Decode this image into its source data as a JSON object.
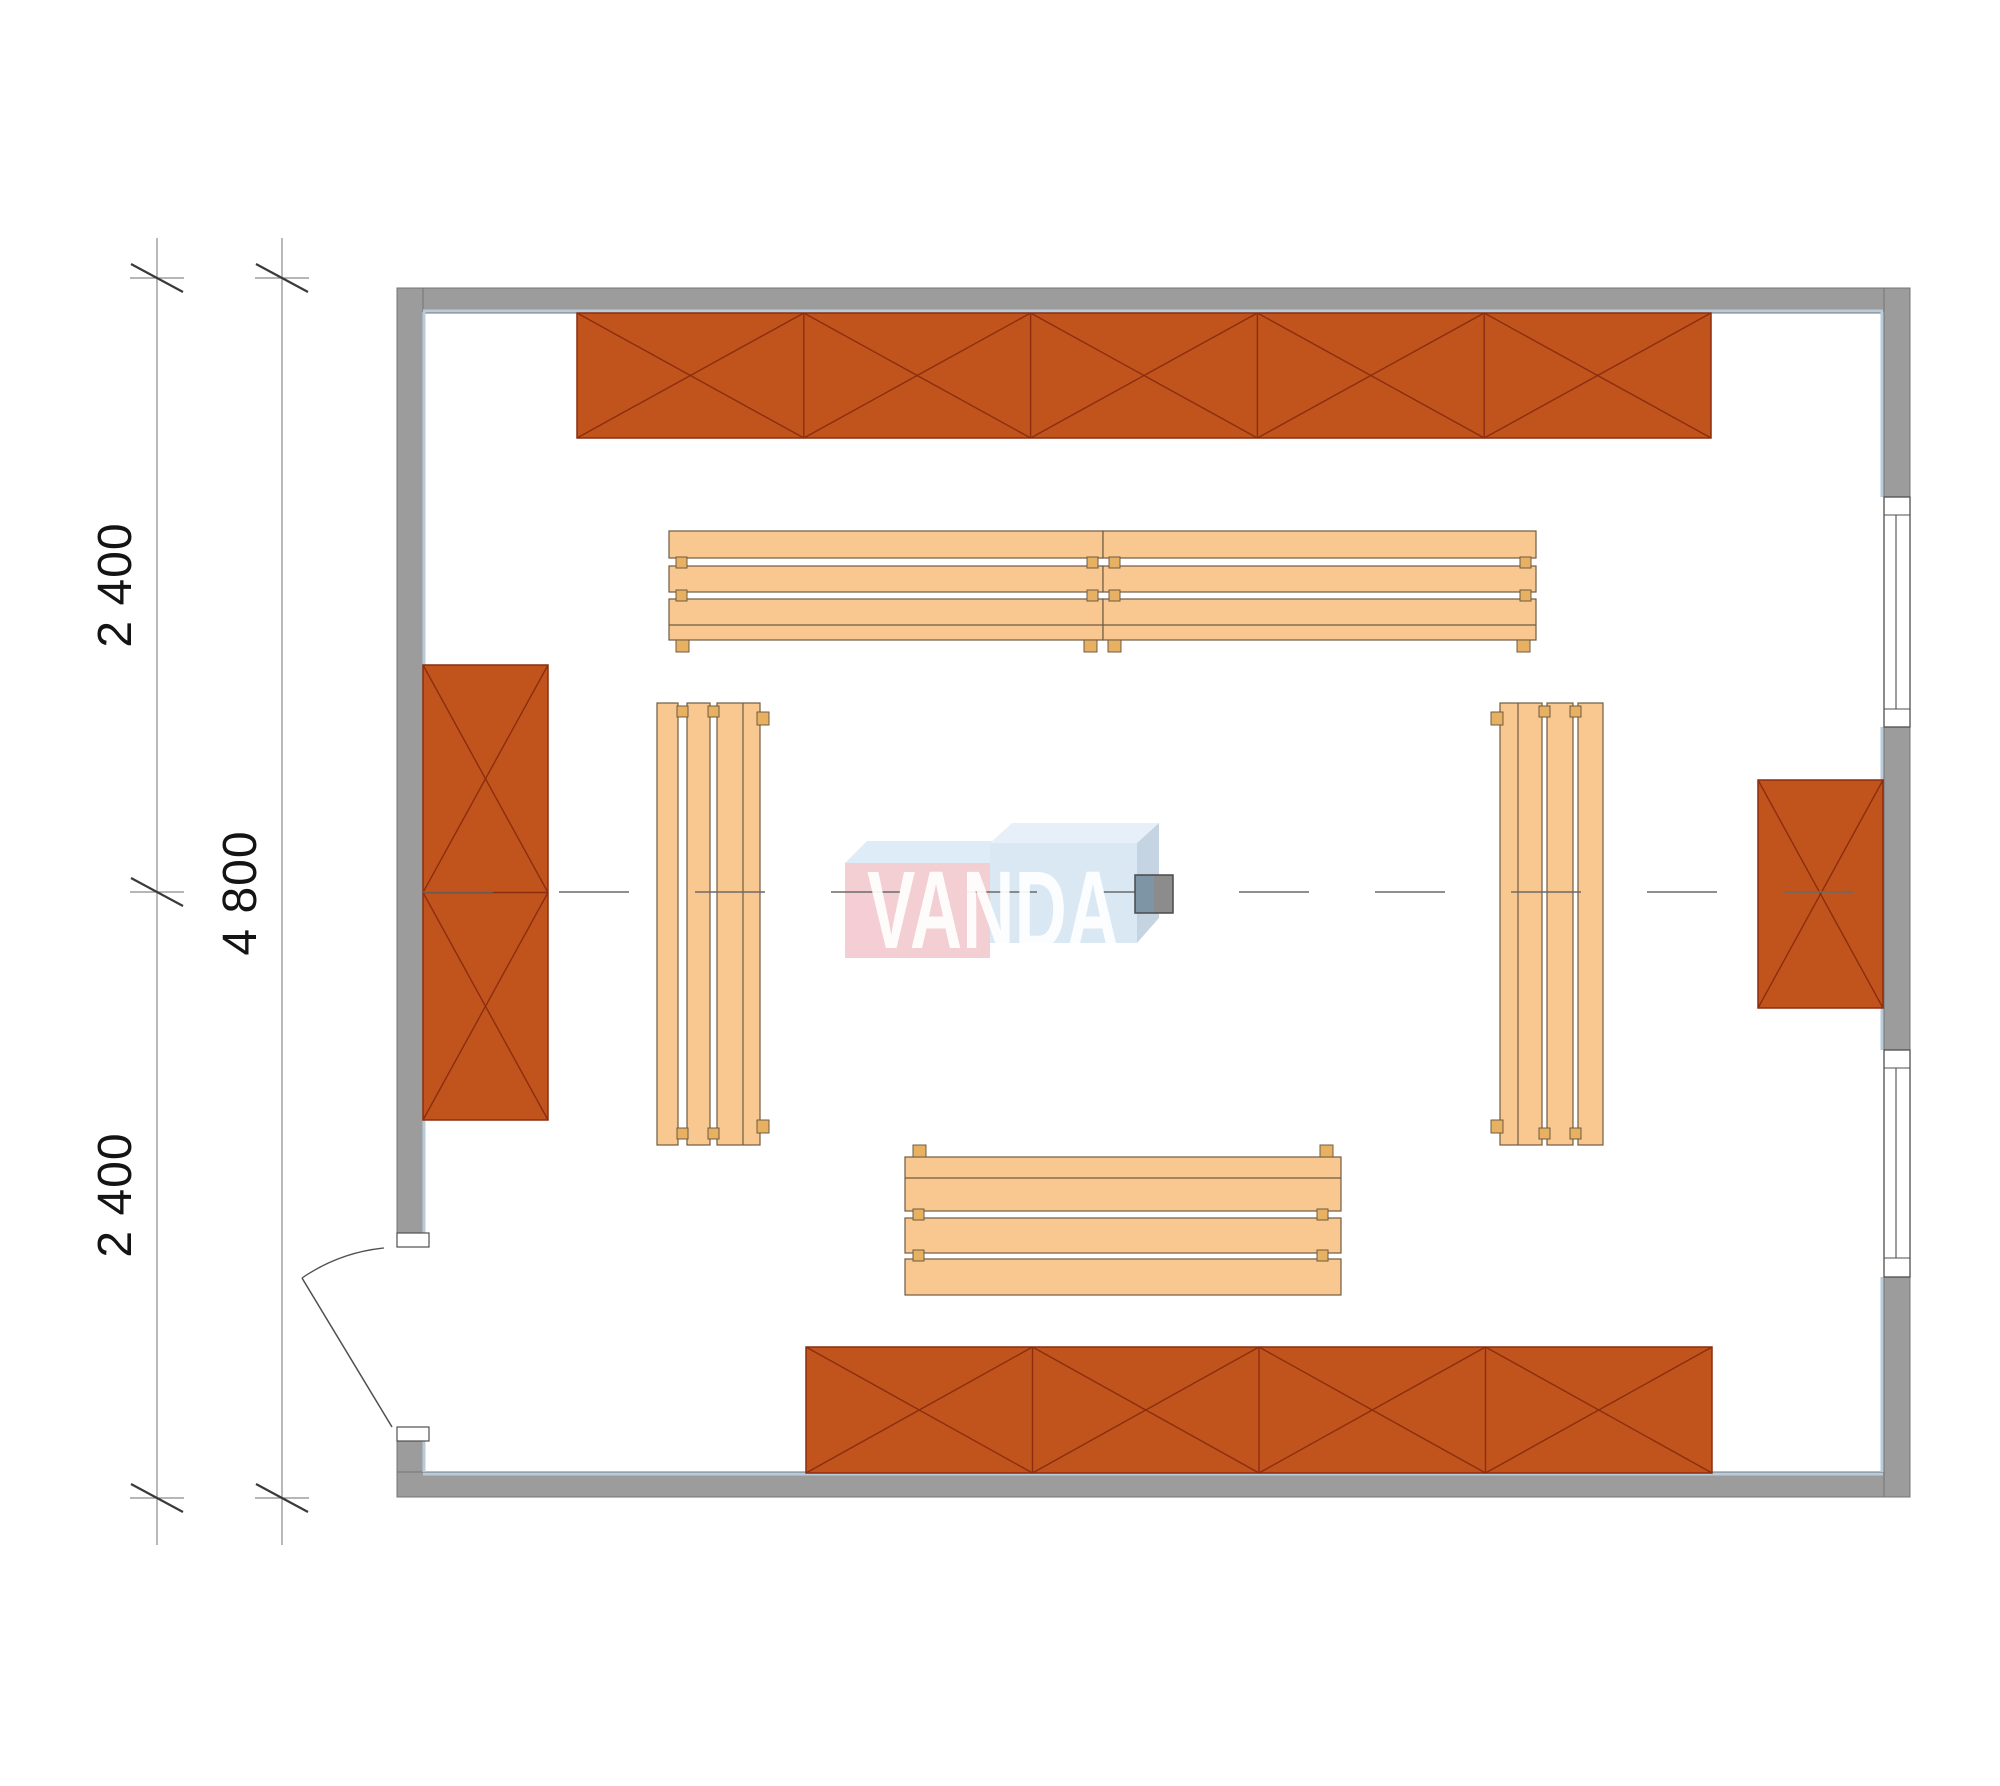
{
  "page": {
    "width": 2000,
    "height": 1786,
    "background": "#ffffff"
  },
  "watermark": {
    "text": "VANDA"
  },
  "dimensions": {
    "labels": [
      {
        "text": "2 400"
      },
      {
        "text": "2 400"
      },
      {
        "text": "4 800"
      }
    ]
  },
  "geometry": {
    "colors": {
      "wall_fill": "#9c9c9c",
      "wall_edge": "#757575",
      "inner_face": "#b7cbdb",
      "shelf_fill": "#c1541d",
      "shelf_line": "#8c2d0e",
      "bench_fill": "#f9c890",
      "bench_line": "#6e5c42",
      "tab_fill": "#e7b161",
      "window_line": "#4f4f4f",
      "door_line": "#4f4f4f",
      "centerline": "#6a6a6a",
      "dim_line": "#8a8a8a",
      "dim_tick": "#3a3a3a",
      "logo_pink": "#f2c6cc",
      "logo_blue_face": "#d4e4f3",
      "logo_blue_top_l": "#d9e9f7",
      "logo_blue_top_r": "#e3eef9",
      "logo_blue_side": "#bccddd",
      "heater_left": "#7e95a6",
      "heater_right": "#8c8c8c",
      "heater_edge": "#4a4a4a"
    },
    "walls": {
      "rects": [
        {
          "name": "wall-top",
          "r": [
            397,
            288,
            1513,
            25
          ]
        },
        {
          "name": "wall-left-upper",
          "r": [
            397,
            288,
            26,
            945
          ]
        },
        {
          "name": "wall-left-lower",
          "r": [
            397,
            1438,
            26,
            59
          ]
        },
        {
          "name": "wall-bottom",
          "r": [
            397,
            1472,
            1513,
            25
          ]
        },
        {
          "name": "wall-right-upper",
          "r": [
            1884,
            288,
            26,
            209
          ]
        },
        {
          "name": "wall-right-middle",
          "r": [
            1884,
            727,
            26,
            323
          ]
        },
        {
          "name": "wall-right-lower",
          "r": [
            1884,
            1277,
            26,
            220
          ]
        }
      ]
    },
    "inner_face_segments": [
      [
        423,
        311,
        1883,
        311
      ],
      [
        423,
        1474,
        1883,
        1474
      ],
      [
        424,
        312,
        424,
        1233
      ],
      [
        424,
        1441,
        424,
        1472
      ],
      [
        1882,
        312,
        1882,
        497
      ],
      [
        1882,
        727,
        1882,
        1050
      ],
      [
        1882,
        1277,
        1882,
        1472
      ]
    ],
    "windows": [
      {
        "name": "window-right-upper",
        "r": [
          1884,
          497,
          26,
          230
        ],
        "lines": [
          [
            1884,
            515,
            1910,
            515
          ],
          [
            1884,
            709,
            1910,
            709
          ],
          [
            1896,
            515,
            1896,
            709
          ]
        ]
      },
      {
        "name": "window-right-lower",
        "r": [
          1884,
          1050,
          26,
          227
        ],
        "lines": [
          [
            1884,
            1068,
            1910,
            1068
          ],
          [
            1884,
            1258,
            1910,
            1258
          ],
          [
            1896,
            1068,
            1896,
            1258
          ]
        ]
      }
    ],
    "door": {
      "jambs": [
        {
          "name": "door-jamb-top",
          "r": [
            397,
            1233,
            32,
            14
          ]
        },
        {
          "name": "door-jamb-bottom",
          "r": [
            397,
            1427,
            32,
            14
          ]
        }
      ],
      "leaf": [
        392,
        1427,
        302,
        1278
      ],
      "arc": "M 384 1248 A 177 177 0 0 0 302 1278"
    },
    "shelves": [
      {
        "name": "shelf-top",
        "x": 577,
        "y": 313,
        "w": 1134,
        "h": 125,
        "cols": 5,
        "rows": 1
      },
      {
        "name": "shelf-left",
        "x": 423,
        "y": 665,
        "w": 125,
        "h": 455,
        "cols": 1,
        "rows": 2
      },
      {
        "name": "shelf-right",
        "x": 1758,
        "y": 780,
        "w": 125,
        "h": 228,
        "cols": 1,
        "rows": 1
      },
      {
        "name": "shelf-bottom",
        "x": 806,
        "y": 1347,
        "w": 906,
        "h": 126,
        "cols": 4,
        "rows": 1
      }
    ],
    "benches": {
      "boards": [
        {
          "name": "bench-top",
          "rects": [
            [
              669,
              531,
              434,
              27
            ],
            [
              669,
              566,
              434,
              26
            ],
            [
              669,
              599,
              434,
              41
            ],
            [
              1103,
              531,
              433,
              27
            ],
            [
              1103,
              566,
              433,
              26
            ],
            [
              1103,
              599,
              433,
              41
            ]
          ],
          "lines": [
            [
              669,
              625,
              1536,
              625
            ]
          ]
        },
        {
          "name": "bench-left",
          "rects": [
            [
              657,
              703,
              21,
              442
            ],
            [
              687,
              703,
              23,
              442
            ],
            [
              717,
              703,
              43,
              442
            ]
          ],
          "lines": [
            [
              743,
              703,
              743,
              1145
            ]
          ]
        },
        {
          "name": "bench-right",
          "rects": [
            [
              1500,
              703,
              42,
              442
            ],
            [
              1547,
              703,
              26,
              442
            ],
            [
              1578,
              703,
              25,
              442
            ]
          ],
          "lines": [
            [
              1518,
              703,
              1518,
              1145
            ]
          ]
        },
        {
          "name": "bench-bottom",
          "rects": [
            [
              905,
              1157,
              436,
              54
            ],
            [
              905,
              1218,
              436,
              35
            ],
            [
              905,
              1259,
              436,
              36
            ]
          ],
          "lines": [
            [
              905,
              1178,
              1341,
              1178
            ]
          ]
        }
      ],
      "tabs": [
        [
          676,
          557,
          11,
          11
        ],
        [
          1087,
          557,
          11,
          11
        ],
        [
          1109,
          557,
          11,
          11
        ],
        [
          1520,
          557,
          11,
          11
        ],
        [
          676,
          590,
          11,
          11
        ],
        [
          1087,
          590,
          11,
          11
        ],
        [
          1109,
          590,
          11,
          11
        ],
        [
          1520,
          590,
          11,
          11
        ],
        [
          677,
          706,
          11,
          11
        ],
        [
          708,
          706,
          11,
          11
        ],
        [
          677,
          1128,
          11,
          11
        ],
        [
          708,
          1128,
          11,
          11
        ],
        [
          1539,
          706,
          11,
          11
        ],
        [
          1570,
          706,
          11,
          11
        ],
        [
          1539,
          1128,
          11,
          11
        ],
        [
          1570,
          1128,
          11,
          11
        ],
        [
          913,
          1209,
          11,
          11
        ],
        [
          1317,
          1209,
          11,
          11
        ],
        [
          913,
          1250,
          11,
          11
        ],
        [
          1317,
          1250,
          11,
          11
        ]
      ],
      "feet": [
        [
          676,
          640,
          13,
          12
        ],
        [
          1084,
          640,
          13,
          12
        ],
        [
          1108,
          640,
          13,
          12
        ],
        [
          1517,
          640,
          13,
          12
        ],
        [
          757,
          712,
          12,
          13
        ],
        [
          757,
          1120,
          12,
          13
        ],
        [
          1491,
          712,
          12,
          13
        ],
        [
          1491,
          1120,
          12,
          13
        ],
        [
          913,
          1145,
          13,
          12
        ],
        [
          1320,
          1145,
          13,
          12
        ]
      ]
    },
    "centerline": {
      "seg": [
        423,
        892,
        1883,
        892
      ],
      "dash": "70 66"
    },
    "heater": {
      "left": [
        1135,
        875,
        19,
        38
      ],
      "right": [
        1154,
        875,
        19,
        38
      ],
      "frame": [
        1135,
        875,
        38,
        38
      ]
    },
    "dimension": {
      "lines": [
        [
          157,
          238,
          157,
          1545
        ],
        [
          282,
          238,
          282,
          1545
        ]
      ],
      "ticks": [
        [
          157,
          278
        ],
        [
          157,
          892
        ],
        [
          157,
          1498
        ],
        [
          282,
          278
        ],
        [
          282,
          1498
        ]
      ],
      "label_pos": [
        {
          "x": 131,
          "y": 585,
          "rot": -90
        },
        {
          "x": 131,
          "y": 1195,
          "rot": -90
        },
        {
          "x": 256,
          "y": 893,
          "rot": -90
        }
      ]
    },
    "logo": {
      "opacity": 0.85,
      "polys": [
        {
          "name": "logo-box-left-top",
          "pts": "867,841 1012,841 990,863 845,863",
          "fill": "logo_blue_top_l"
        },
        {
          "name": "logo-box-left-face",
          "rect": [
            845,
            863,
            145,
            95
          ],
          "fill": "logo_pink"
        },
        {
          "name": "logo-box-right-top",
          "pts": "1012,823 1159,823 1137,843 990,843",
          "fill": "logo_blue_top_r"
        },
        {
          "name": "logo-box-right-face",
          "rect": [
            990,
            843,
            147,
            100
          ],
          "fill": "logo_blue_face"
        },
        {
          "name": "logo-box-right-side",
          "pts": "1137,843 1159,823 1159,918 1137,943",
          "fill": "logo_blue_side"
        }
      ]
    }
  }
}
